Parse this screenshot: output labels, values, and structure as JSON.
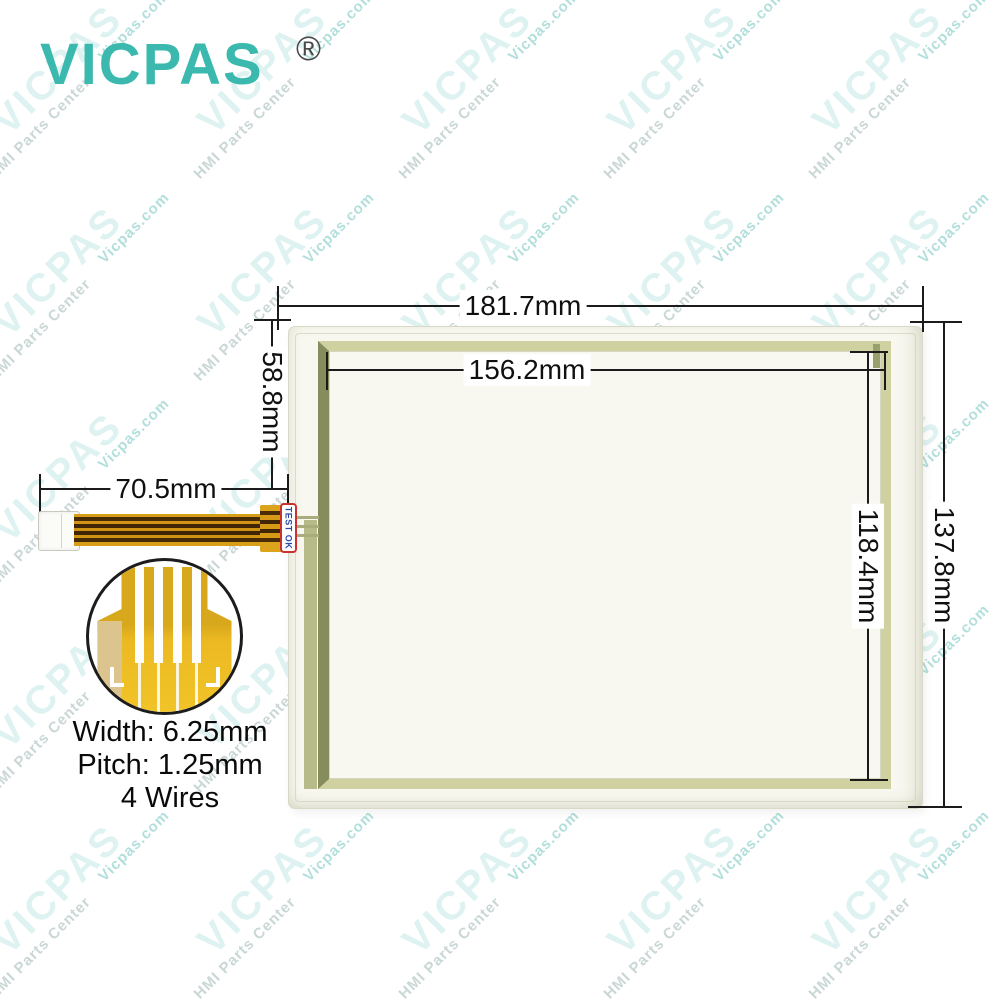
{
  "logo": {
    "brand": "VICPAS",
    "registered": "®"
  },
  "watermark": {
    "brand": "VICPAS",
    "site": "Vicpas.com",
    "org": "HMI Parts Center"
  },
  "dimensions": {
    "outer_width": "181.7mm",
    "active_width": "156.2mm",
    "tail_offset_height": "58.8mm",
    "cable_length": "70.5mm",
    "active_height": "118.4mm",
    "outer_height": "137.8mm"
  },
  "cable": {
    "test_label": "TEST OK"
  },
  "connector_specs": {
    "width": "Width: 6.25mm",
    "pitch": "Pitch: 1.25mm",
    "wires": "4 Wires"
  },
  "colors": {
    "brand_teal": "#3cb9ae",
    "panel_glass": "#f8f8f0",
    "active_border_olive": "#cfd2a0",
    "active_border_dark": "#878c5c",
    "cable_gold": "#d79e18",
    "sticker_text_blue": "#2a49a8",
    "sticker_border_red": "#cc3030"
  }
}
